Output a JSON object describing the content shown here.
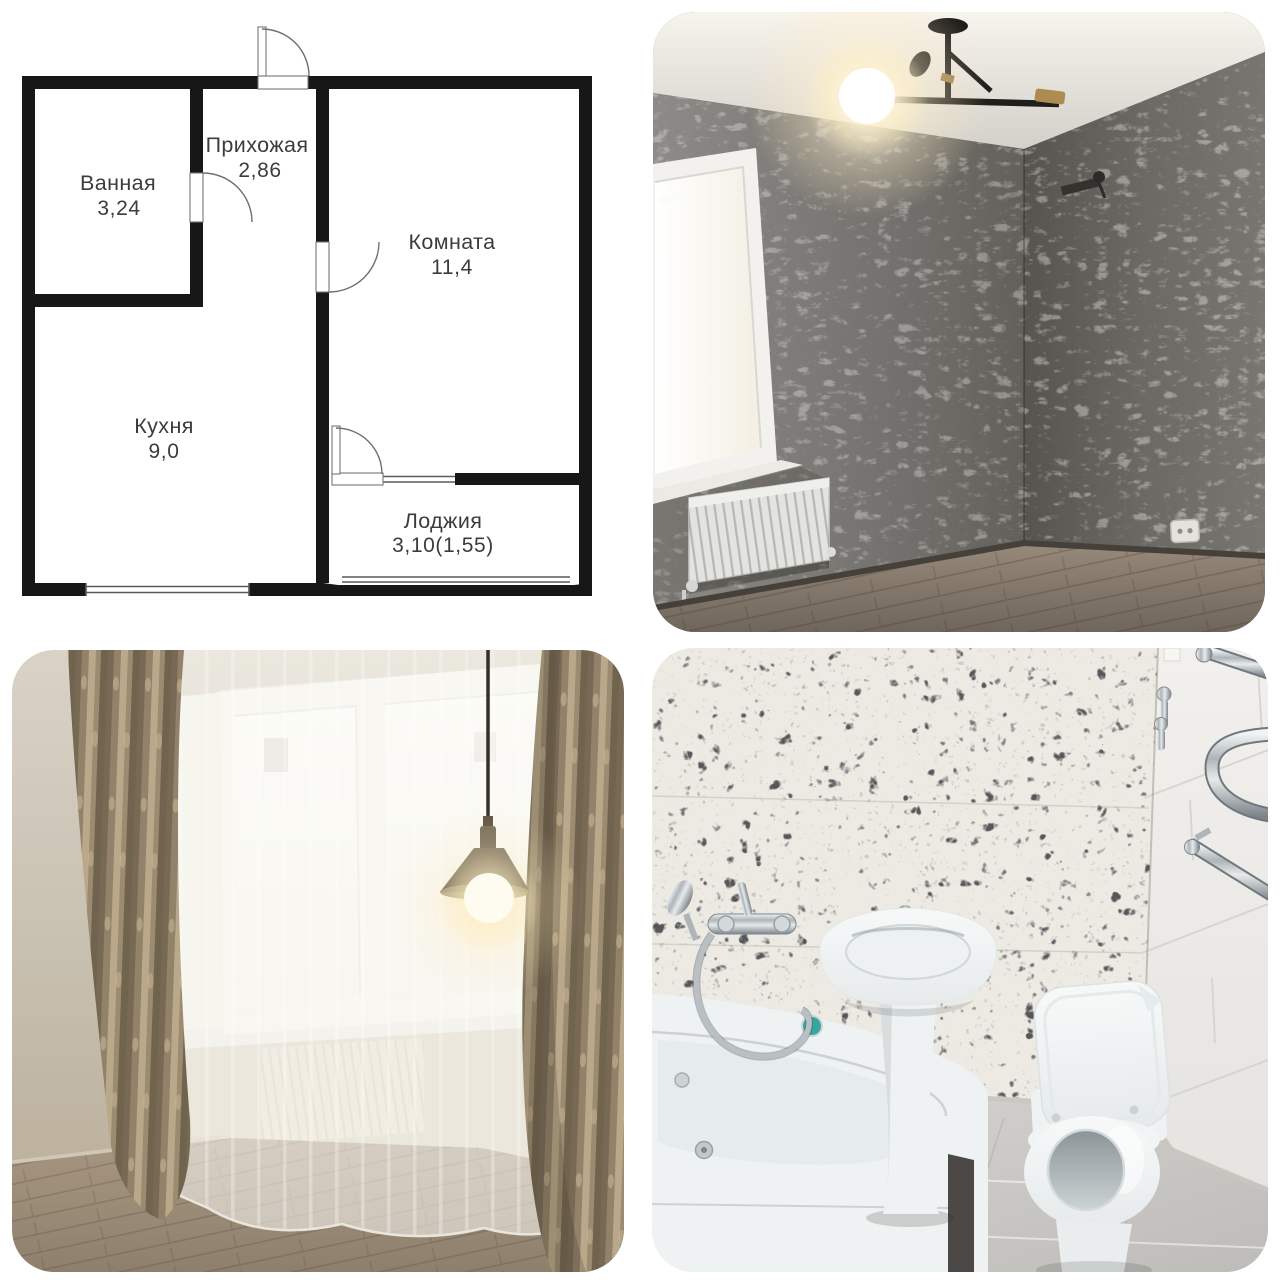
{
  "background": "#ffffff",
  "floor_plan": {
    "wall_color": "#171717",
    "label_color": "#3c3c3c",
    "rooms": [
      {
        "name": "Ванная",
        "area": "3,24"
      },
      {
        "name": "Прихожая",
        "area": "2,86"
      },
      {
        "name": "Комната",
        "area": "11,4"
      },
      {
        "name": "Кухня",
        "area": "9,0"
      },
      {
        "name": "Лоджия",
        "area": "3,10(1,55)"
      }
    ]
  },
  "photos": {
    "top_right": {
      "name": "room-gray-wallpaper",
      "palette": {
        "wall": "#6e6c68",
        "ceiling": "#e8e4dd",
        "floor": "#86796c",
        "glow": "#fff3d6"
      }
    },
    "bottom_left": {
      "name": "room-window-curtains",
      "palette": {
        "wall": "#c9c0b0",
        "curtain": "#8d7d64",
        "sheer": "#f4f2ee",
        "floor": "#98876f"
      }
    },
    "bottom_right": {
      "name": "bathroom",
      "palette": {
        "terrazzo": "#edeae3",
        "tile": "#efedea",
        "porcelain": "#f2f5f5",
        "chrome": "#aeb5b9",
        "floor": "#d3d1cd"
      }
    }
  }
}
